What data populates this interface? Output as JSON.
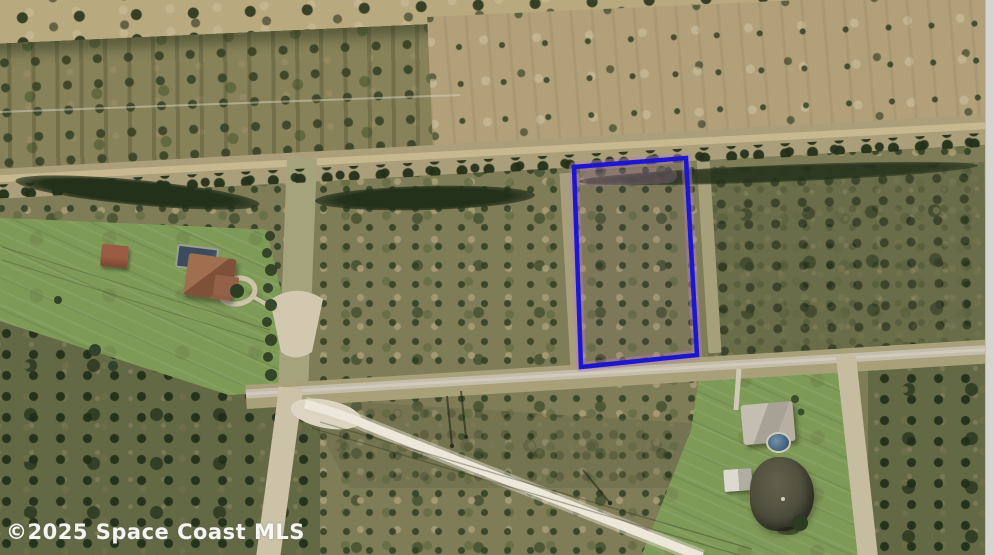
{
  "meta": {
    "type": "aerial-parcel-photo",
    "description": "Aerial / satellite MLS listing photo of a vacant wooded lot outlined in blue, surrounded by scrub land, a road intersection, and two rural homes",
    "width": 994,
    "height": 555
  },
  "watermark": {
    "text": "©2025 Space Coast MLS",
    "color": "#ffffff"
  },
  "parcel_outline": {
    "points": "574,167 686,158 697,355 581,367",
    "stroke_color": "#1b18cb",
    "halo_color": "#b57fc4"
  },
  "palette": {
    "scrub": "#7f7c58",
    "woods": "#636845",
    "pasture": "#b1a07a",
    "field": "#b9a97f",
    "lawn": "#7e9a57",
    "road": "#c5bdab",
    "sandy_road": "#ece7d8",
    "dirt": "#cfc5ab",
    "pond": "#4e4f3d",
    "pool": "#3f6fa3",
    "photo_edge": "#d5d4d1"
  }
}
